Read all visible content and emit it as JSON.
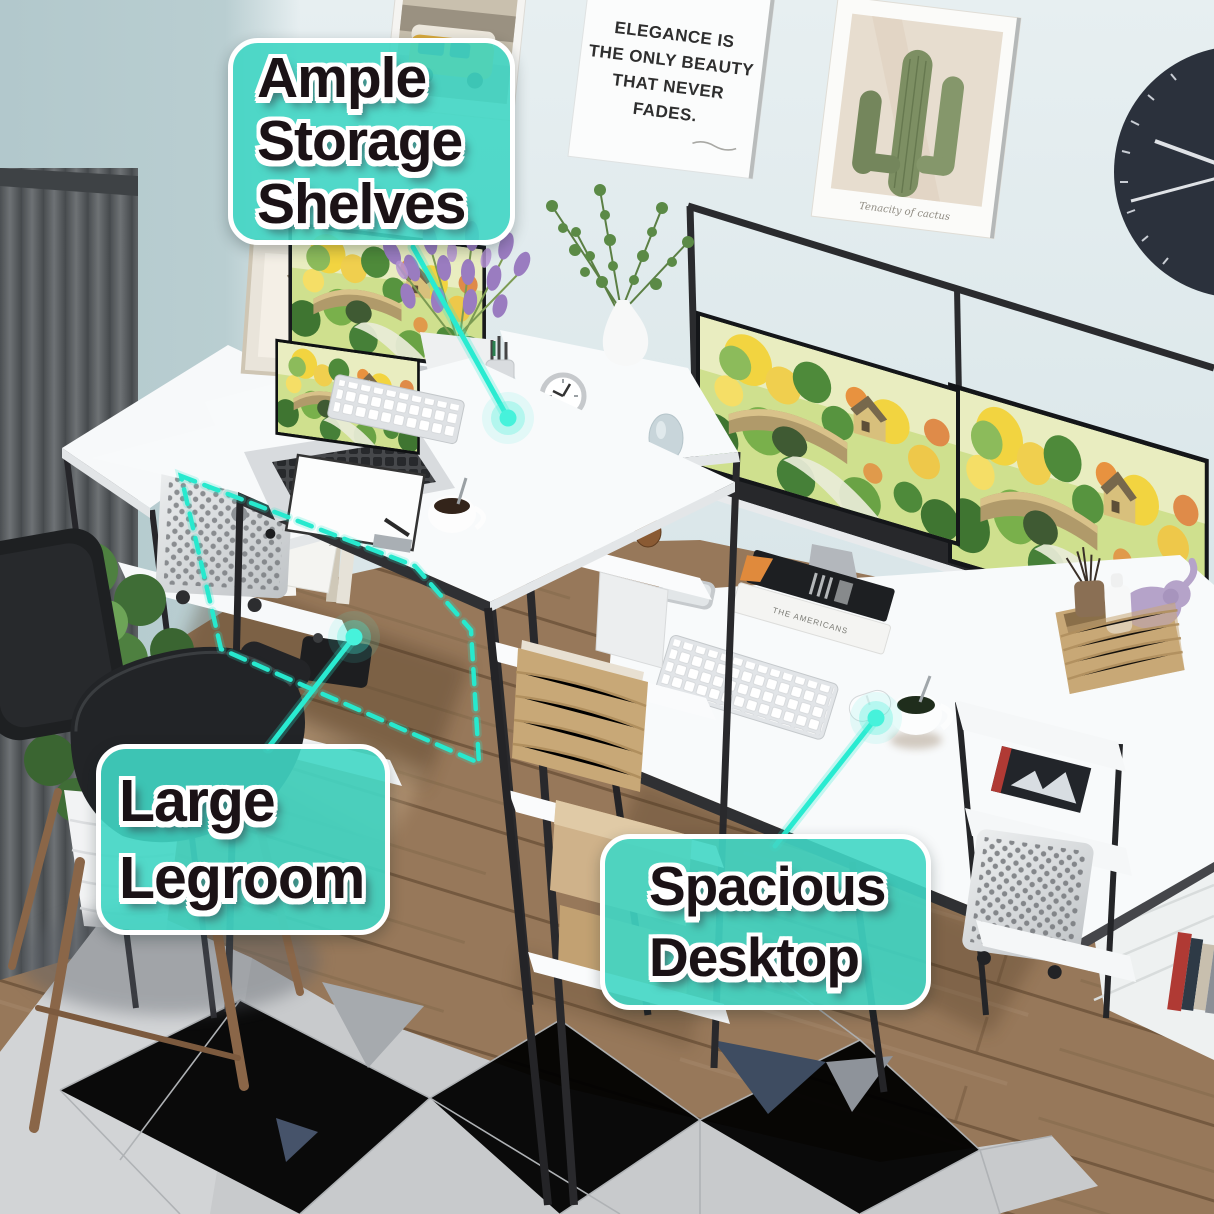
{
  "callouts": {
    "storage": {
      "lines": [
        "Ample",
        "Storage",
        "Shelves"
      ]
    },
    "legroom": {
      "lines": [
        "Large",
        "Legroom"
      ]
    },
    "desktop": {
      "lines": [
        "Spacious",
        "Desktop"
      ]
    }
  },
  "posters": {
    "quote": {
      "lines": [
        "ELEGANCE IS",
        "THE ONLY BEAUTY",
        "THAT NEVER",
        "FADES."
      ]
    },
    "cactus": {
      "caption": "Tenacity of cactus"
    }
  },
  "books": {
    "tower_book_label": "TRINITY",
    "desk_book_label": "THE AMERICANS"
  },
  "colors": {
    "accent_teal": "#3EDAC4",
    "leader_line": "#29EBD1",
    "callout_text": "#1B1216",
    "wall": "#DCE7EA",
    "curtain": "#5F6366",
    "floor_wood": "#97785A",
    "rug": "#C8CACC",
    "rug_navy_accent": "#3E4C61",
    "desk_surface": "#F8FAFB",
    "frame_black": "#2A2B2E",
    "basket_tan": "#C8A877",
    "plant_green": "#4E7A42",
    "lavender": "#9B7FBE"
  },
  "scene": {
    "objects": [
      "gray-curtain",
      "potted-plant",
      "black-desk-chair",
      "l-shaped-desk",
      "storage-shelf-tower",
      "mac-pro-tower",
      "macbook-laptop",
      "desktop-monitor",
      "dual-monitors",
      "apple-keyboard",
      "magic-mouse",
      "clipboard-paper",
      "coffee-cup",
      "alarm-clock",
      "white-flower-vase",
      "eucalyptus-plant",
      "wicker-baskets",
      "pinecones",
      "candles-on-books",
      "camera",
      "picture-frame",
      "reed-diffuser-basket",
      "elephant-figurine",
      "wall-clock",
      "van-poster",
      "quote-poster",
      "cactus-poster",
      "geometric-rug",
      "wood-floor",
      "white-ladder-shelf"
    ]
  }
}
